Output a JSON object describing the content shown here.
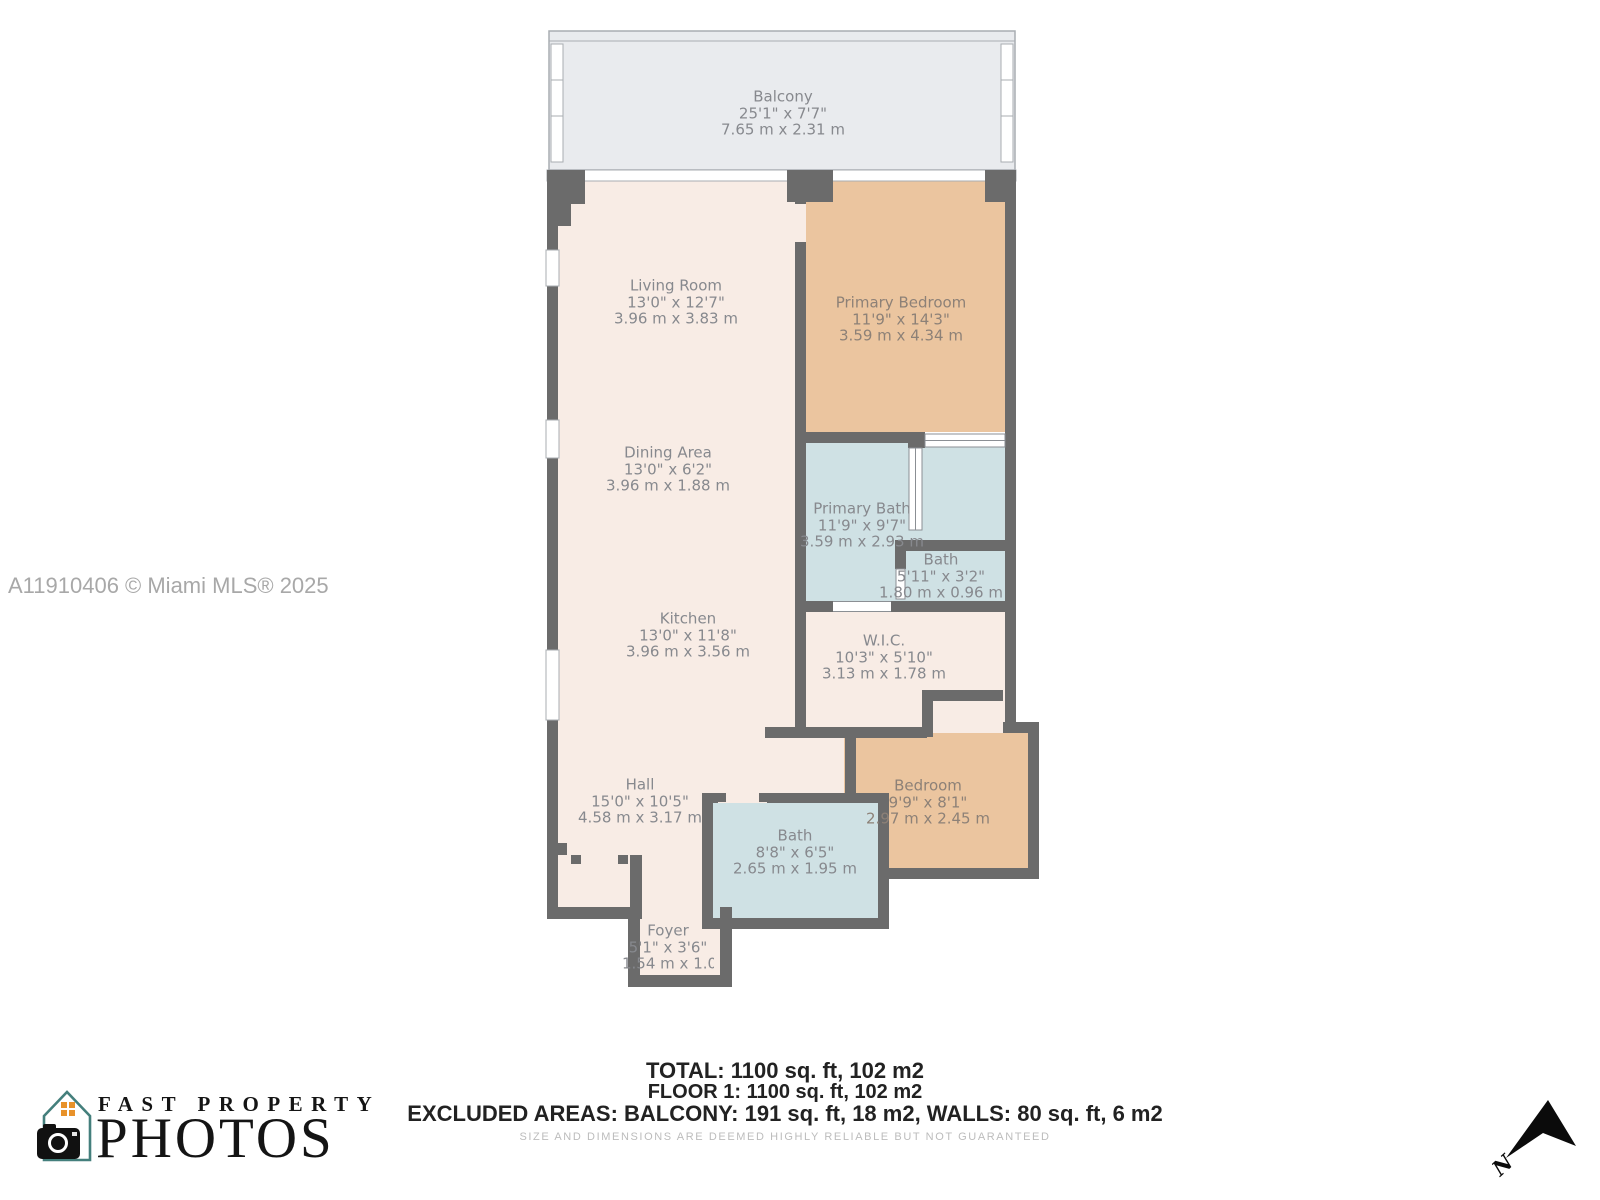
{
  "watermark": "A11910406 © Miami MLS® 2025",
  "rooms": {
    "balcony": {
      "name": "Balcony",
      "imperial": "25'1\" x 7'7\"",
      "metric": "7.65 m x 2.31 m"
    },
    "living_room": {
      "name": "Living Room",
      "imperial": "13'0\" x 12'7\"",
      "metric": "3.96 m x 3.83 m"
    },
    "primary_bedroom": {
      "name": "Primary Bedroom",
      "imperial": "11'9\" x 14'3\"",
      "metric": "3.59 m x 4.34 m"
    },
    "dining_area": {
      "name": "Dining Area",
      "imperial": "13'0\" x 6'2\"",
      "metric": "3.96 m x 1.88 m"
    },
    "primary_bath": {
      "name": "Primary Bath",
      "imperial": "11'9\" x 9'7\"",
      "metric": "3.59 m x 2.93 m"
    },
    "bath_small": {
      "name": "Bath",
      "imperial": "5'11\" x 3'2\"",
      "metric": "1.80 m x 0.96 m"
    },
    "kitchen": {
      "name": "Kitchen",
      "imperial": "13'0\" x 11'8\"",
      "metric": "3.96 m x 3.56 m"
    },
    "wic": {
      "name": "W.I.C.",
      "imperial": "10'3\" x 5'10\"",
      "metric": "3.13 m x 1.78 m"
    },
    "hall": {
      "name": "Hall",
      "imperial": "15'0\" x 10'5\"",
      "metric": "4.58 m x 3.17 m"
    },
    "bedroom": {
      "name": "Bedroom",
      "imperial": "9'9\" x 8'1\"",
      "metric": "2.97 m x 2.45 m"
    },
    "bath": {
      "name": "Bath",
      "imperial": "8'8\" x 6'5\"",
      "metric": "2.65 m x 1.95 m"
    },
    "foyer": {
      "name": "Foyer",
      "imperial": "5'1\" x 3'6\"",
      "metric": "1.54 m x 1.07 m"
    }
  },
  "summary": {
    "total": "TOTAL: 1100 sq. ft, 102 m2",
    "floor1": "FLOOR 1: 1100 sq. ft, 102 m2",
    "excluded": "EXCLUDED AREAS: BALCONY: 191 sq. ft, 18 m2, WALLS: 80 sq. ft, 6 m2",
    "disclaimer": "SIZE AND DIMENSIONS ARE DEEMED HIGHLY RELIABLE BUT NOT GUARANTEED"
  },
  "logo": {
    "line1": "FAST PROPERTY",
    "line2": "PHOTOS"
  },
  "compass": {
    "label": "N"
  },
  "colors": {
    "wall": "#6b6b6b",
    "room_cream": "#f8ece5",
    "room_tan": "#ebc59f",
    "room_blue": "#cfe1e4",
    "balcony_gray": "#e9ebee",
    "label_text": "#87898e",
    "logo_teal": "#447f7c",
    "logo_orange": "#e8922a"
  }
}
